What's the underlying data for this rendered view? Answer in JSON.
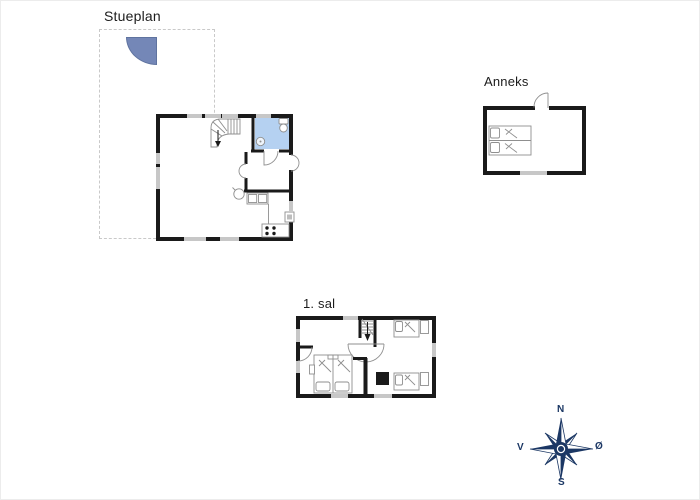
{
  "labels": {
    "ground_floor": "Stueplan",
    "annex": "Anneks",
    "first_floor": "1. sal"
  },
  "compass": {
    "north": "N",
    "south": "S",
    "west": "V",
    "east": "Ø"
  },
  "colors": {
    "wall": "#1a1a1a",
    "window": "#c7c7c7",
    "bathroom_fill": "#b5d1f1",
    "terrace_fill": "#7487b7",
    "terrace_edge": "#5f739f",
    "compass": "#1b3764",
    "fixture": "#8f8f8f",
    "dashed": "#c9c9c9",
    "label": "#1c1c1c"
  }
}
